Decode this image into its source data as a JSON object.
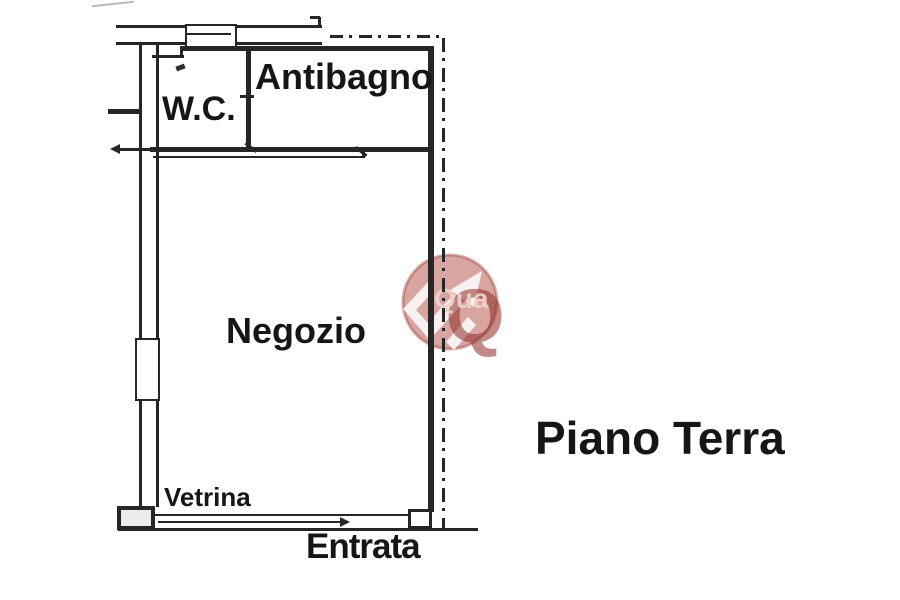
{
  "plan": {
    "rooms": {
      "wc": "W.C.",
      "antibagno": "Antibagno",
      "negozio": "Negozio"
    },
    "annotations": {
      "vetrina": "Vetrina",
      "entrata": "Entrata"
    },
    "floor_title": "Piano Terra"
  },
  "watermark": {
    "letter": "Q",
    "brand_fragment": "Qua",
    "circle_color": "#b24c44",
    "letter_color": "#8e2a24",
    "arrow_color": "#ffffff"
  },
  "colors": {
    "wall": "#262626",
    "background": "#ffffff"
  }
}
